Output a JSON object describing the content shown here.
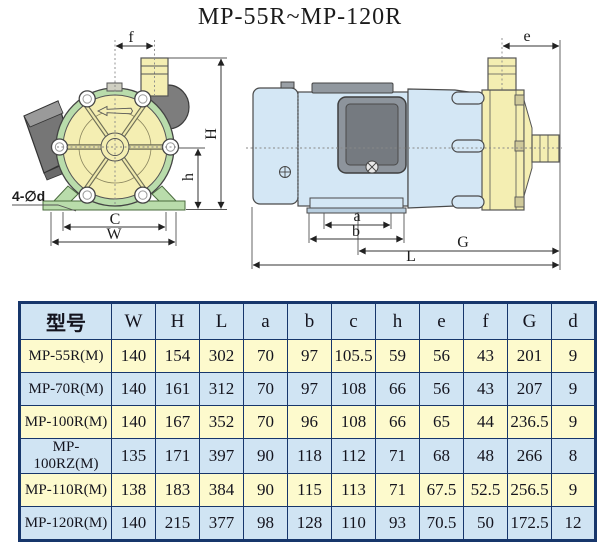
{
  "title": "MP-55R~MP-120R",
  "diagram": {
    "labels": {
      "f": "f",
      "e": "e",
      "H": "H",
      "h": "h",
      "C": "C",
      "W": "W",
      "a": "a",
      "b": "b",
      "G": "G",
      "L": "L",
      "holes": "4-∅d"
    }
  },
  "table": {
    "model_header": "型号",
    "dim_headers": [
      "W",
      "H",
      "L",
      "a",
      "b",
      "c",
      "h",
      "e",
      "f",
      "G",
      "d"
    ],
    "rows": [
      {
        "model": "MP-55R(M)",
        "values": [
          140,
          154,
          302,
          70,
          97,
          105.5,
          59,
          56,
          43,
          201,
          9
        ]
      },
      {
        "model": "MP-70R(M)",
        "values": [
          140,
          161,
          312,
          70,
          97,
          108,
          66,
          56,
          43,
          207,
          9
        ]
      },
      {
        "model": "MP-100R(M)",
        "values": [
          140,
          167,
          352,
          70,
          96,
          108,
          66,
          65,
          44,
          236.5,
          9
        ]
      },
      {
        "model": "MP-100RZ(M)",
        "values": [
          135,
          171,
          397,
          90,
          118,
          112,
          71,
          68,
          48,
          266,
          8
        ]
      },
      {
        "model": "MP-110R(M)",
        "values": [
          138,
          183,
          384,
          90,
          115,
          113,
          71,
          67.5,
          52.5,
          256.5,
          9
        ]
      },
      {
        "model": "MP-120R(M)",
        "values": [
          140,
          215,
          377,
          98,
          128,
          110,
          93,
          70.5,
          50,
          172.5,
          12
        ]
      }
    ]
  },
  "colors": {
    "table_border_navy": "#17366b",
    "row_yellow": "#fdfacd",
    "row_blue": "#d0e4f3",
    "pump_yellow": "#f4eeb2",
    "casing_green": "#b9dcab",
    "motor_blue": "#d4e7f5",
    "metal_gray": "#7d7d7d"
  }
}
